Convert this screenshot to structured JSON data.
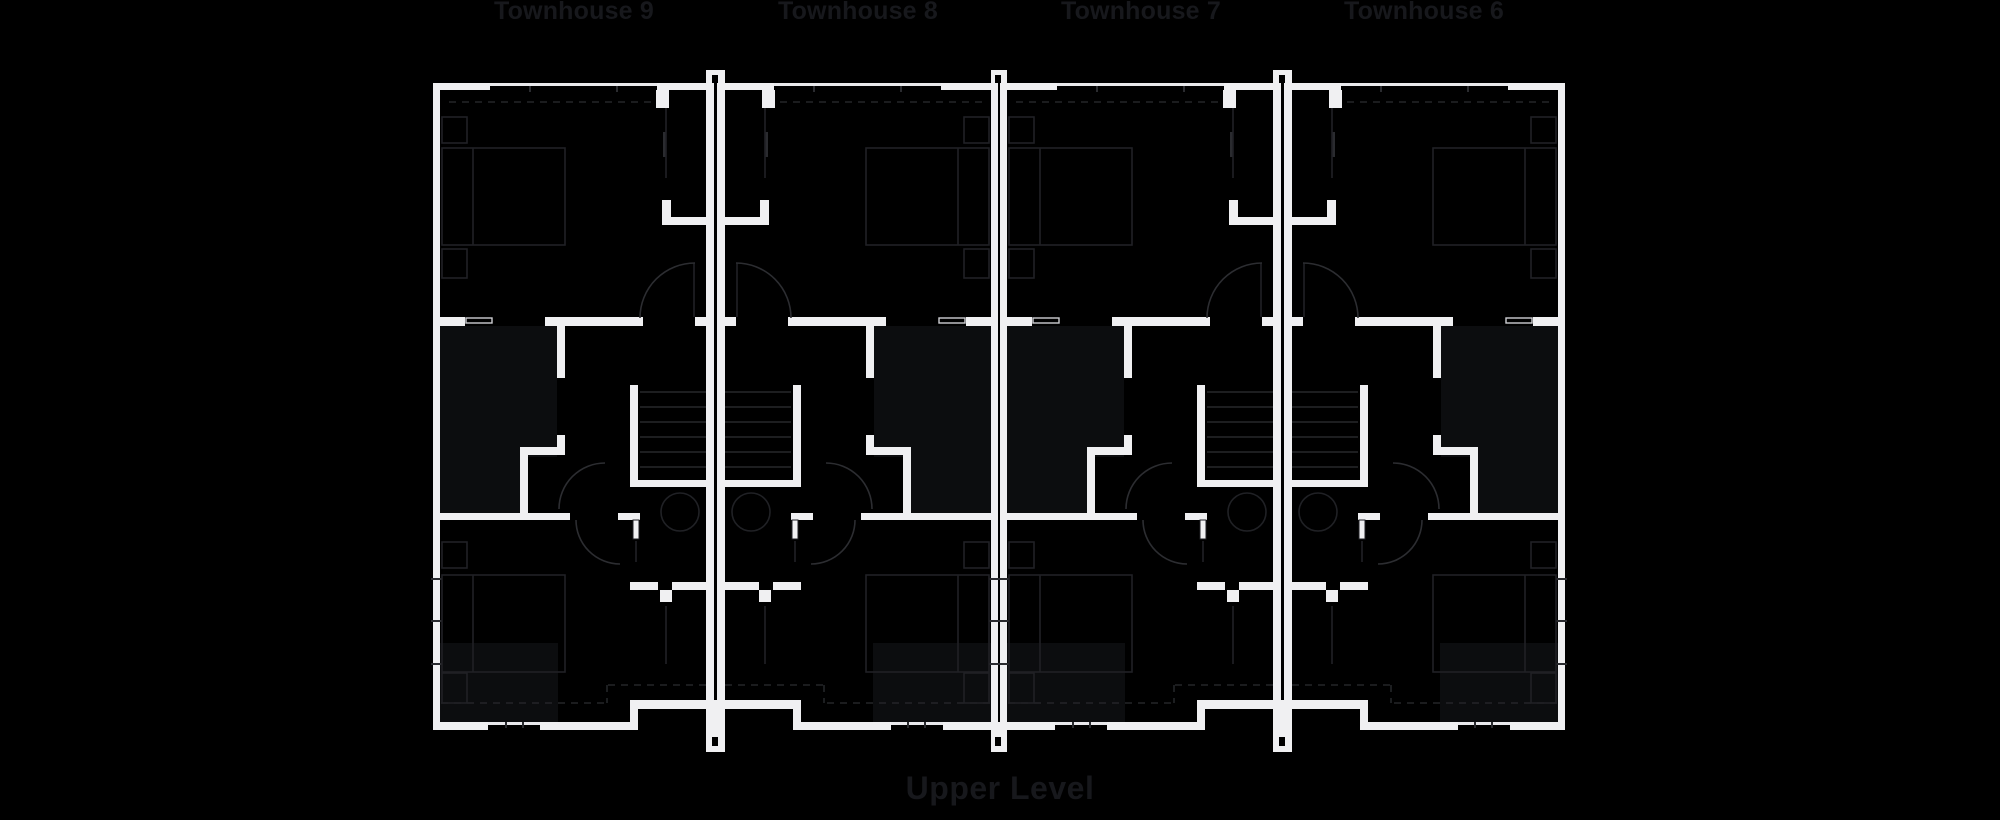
{
  "level_label": "Upper Level",
  "colors": {
    "background": "#000000",
    "wall": "#f0f0f2",
    "room_shade": "#0c0d0f",
    "alcove": "#000000",
    "furniture_line": "#202125",
    "tread_line": "#27282b",
    "arc_line": "#2c2d31",
    "dash_line": "#242529",
    "window_line": "#e9e9ec",
    "window_frame": "#cdced2",
    "tick": "#2a2b2f",
    "label_text": "#17181c"
  },
  "plan": {
    "canvas": {
      "w": 2000,
      "h": 820
    },
    "units": [
      {
        "name": "townhouse-9",
        "label": "Townhouse 9",
        "label_x": 574,
        "mirror": false,
        "offset": 0
      },
      {
        "name": "townhouse-8",
        "label": "Townhouse 8",
        "label_x": 858,
        "mirror": true,
        "axis": 1431
      },
      {
        "name": "townhouse-7",
        "label": "Townhouse 7",
        "label_x": 1141,
        "mirror": false,
        "offset": 567
      },
      {
        "name": "townhouse-6",
        "label": "Townhouse 6",
        "label_x": 1424,
        "mirror": true,
        "axis": 1998
      }
    ],
    "party_walls": [
      {
        "x": 706,
        "w": 19,
        "gx": 712,
        "tall_foot": true
      },
      {
        "x": 991,
        "w": 16,
        "gx": 995,
        "tall_foot": false
      },
      {
        "x": 1273,
        "w": 19,
        "gx": 1279,
        "tall_foot": true
      }
    ],
    "unit_template": {
      "shade_rects": [
        [
          440,
          326,
          117,
          187
        ],
        [
          437,
          643,
          121,
          79
        ]
      ],
      "alcove_rects": [
        [
          528,
          457,
          29,
          56
        ]
      ],
      "walls": [
        [
          433,
          83,
          7,
          647
        ],
        [
          706,
          83,
          8,
          662
        ],
        [
          433,
          83,
          57,
          7
        ],
        [
          657,
          83,
          49,
          7
        ],
        [
          656,
          90,
          13,
          18
        ],
        [
          662,
          200,
          9,
          25
        ],
        [
          662,
          217,
          44,
          8
        ],
        [
          433,
          317,
          32,
          9
        ],
        [
          545,
          317,
          98,
          9
        ],
        [
          695,
          317,
          11,
          9
        ],
        [
          557,
          323,
          8,
          55
        ],
        [
          557,
          435,
          8,
          20
        ],
        [
          520,
          447,
          45,
          8
        ],
        [
          520,
          455,
          8,
          58
        ],
        [
          433,
          513,
          137,
          7
        ],
        [
          618,
          513,
          22,
          7
        ],
        [
          630,
          385,
          8,
          95
        ],
        [
          630,
          480,
          77,
          7
        ],
        [
          630,
          582,
          28,
          8
        ],
        [
          672,
          582,
          35,
          8
        ],
        [
          660,
          590,
          12,
          12
        ],
        [
          630,
          700,
          77,
          9
        ],
        [
          630,
          700,
          8,
          30
        ],
        [
          433,
          722,
          55,
          8
        ],
        [
          540,
          722,
          97,
          8
        ]
      ],
      "leaf_rects": [
        [
          633,
          520,
          6,
          19
        ]
      ],
      "window_lines": [
        [
          490,
          83,
          167,
          3
        ],
        [
          488,
          722,
          52,
          3
        ]
      ],
      "window_frames": [
        [
          466,
          318,
          26,
          5
        ]
      ],
      "furniture_rects": [
        [
          442,
          148,
          123,
          97
        ],
        [
          442,
          117,
          25,
          26
        ],
        [
          442,
          249,
          25,
          29
        ],
        [
          442,
          575,
          123,
          97
        ],
        [
          442,
          542,
          25,
          26
        ],
        [
          442,
          673,
          25,
          30
        ]
      ],
      "furniture_lines": [
        [
          473,
          148,
          473,
          245
        ],
        [
          473,
          575,
          473,
          672
        ],
        [
          666,
          108,
          666,
          178
        ],
        [
          694,
          263,
          694,
          317
        ],
        [
          666,
          606,
          666,
          664
        ],
        [
          636,
          541,
          636,
          562
        ]
      ],
      "tread_lines": [
        [
          640,
          392,
          706,
          392
        ],
        [
          640,
          407,
          706,
          407
        ],
        [
          640,
          422,
          706,
          422
        ],
        [
          640,
          437,
          706,
          437
        ],
        [
          640,
          452,
          706,
          452
        ],
        [
          640,
          467,
          706,
          467
        ]
      ],
      "circles": [
        [
          680,
          512,
          19
        ]
      ],
      "arcs": [
        "M640,318 A55 55 0 0 1 695,263",
        "M559,509 A46 46 0 0 1 605,463",
        "M576,520 A44 44 0 0 0 620,564"
      ],
      "dashed_lines": [
        [
          449,
          102,
          659,
          102
        ],
        [
          441,
          703,
          607,
          703
        ],
        [
          607,
          685,
          607,
          703
        ],
        [
          608,
          685,
          706,
          685
        ]
      ],
      "dark_ticks": [
        [
          663,
          132,
          3,
          25
        ],
        [
          529,
          86,
          2,
          6
        ],
        [
          616,
          86,
          2,
          6
        ],
        [
          505,
          722,
          2,
          6
        ],
        [
          522,
          722,
          2,
          6
        ],
        [
          431,
          578,
          11,
          2
        ],
        [
          431,
          620,
          11,
          2
        ],
        [
          431,
          663,
          11,
          2
        ]
      ]
    }
  }
}
